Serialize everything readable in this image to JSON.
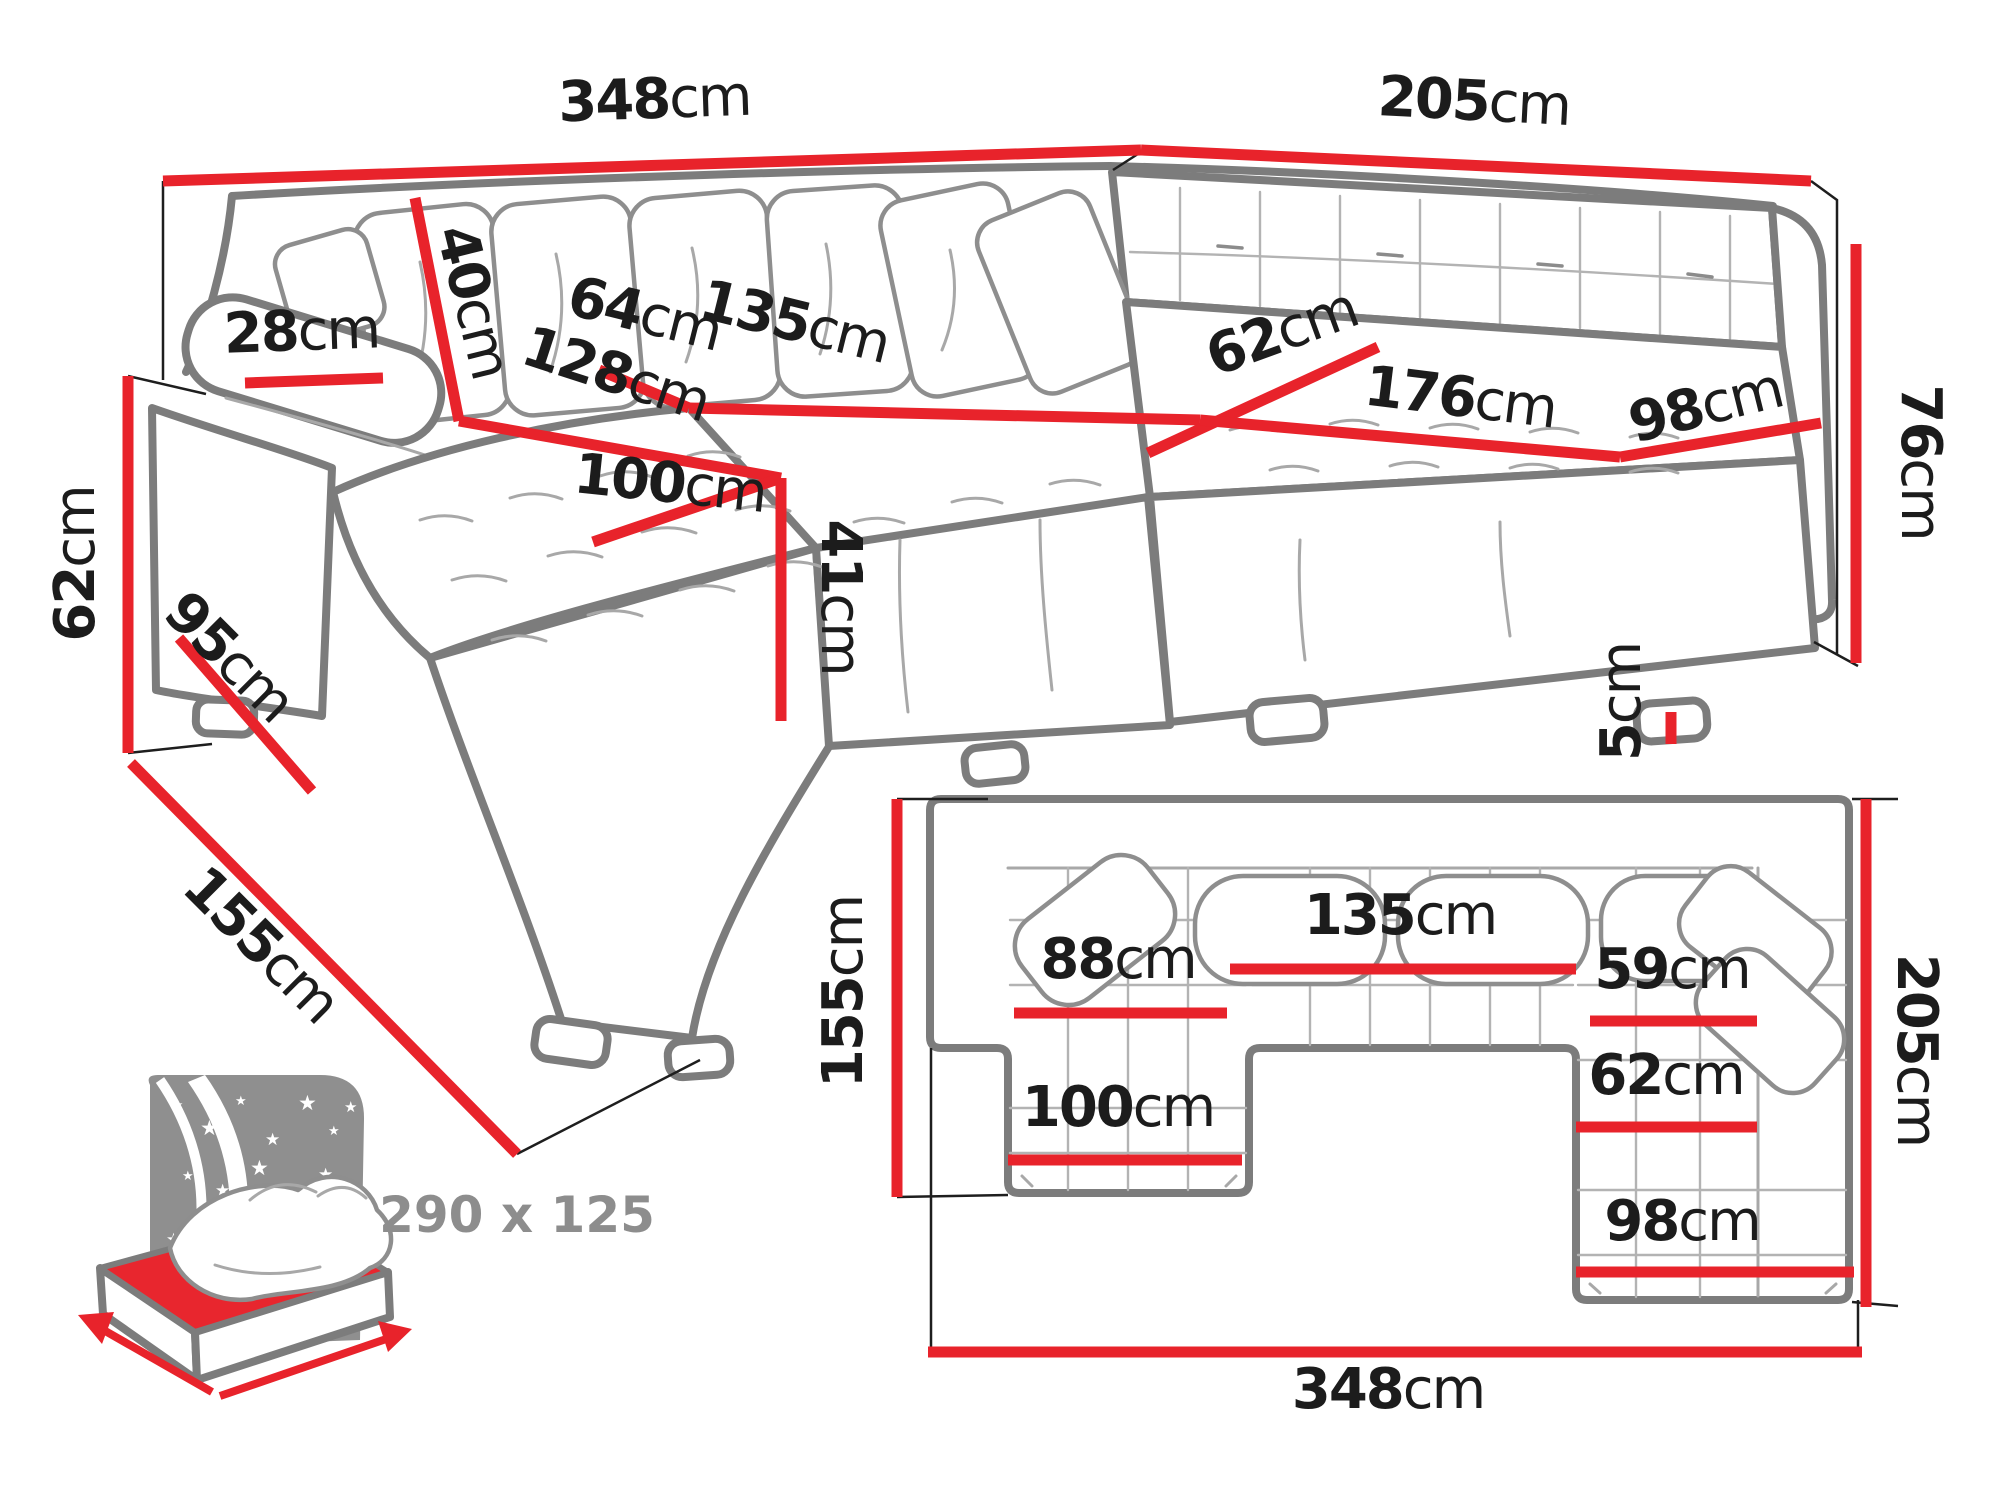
{
  "colors": {
    "dimension_red": "#e8232b",
    "sofa_outline_gray": "#7c7c7c",
    "label_black": "#1c1c1c",
    "bed_gray": "#8f8f8f",
    "bed_text_gray": "#8d8d8d"
  },
  "perspective_view": {
    "back_width": {
      "num": "348",
      "unit": "cm"
    },
    "right_width": {
      "num": "205",
      "unit": "cm"
    },
    "armrest_height": {
      "num": "62",
      "unit": "cm"
    },
    "armrest_top_depth": {
      "num": "28",
      "unit": "cm"
    },
    "armrest_base_length": {
      "num": "95",
      "unit": "cm"
    },
    "side_depth": {
      "num": "155",
      "unit": "cm"
    },
    "back_cushion_height": {
      "num": "40",
      "unit": "cm"
    },
    "seat_depth": {
      "num": "64",
      "unit": "cm"
    },
    "middle_seat_width": {
      "num": "135",
      "unit": "cm"
    },
    "chaise_length": {
      "num": "128",
      "unit": "cm"
    },
    "chaise_width": {
      "num": "100",
      "unit": "cm"
    },
    "seat_height": {
      "num": "41",
      "unit": "cm"
    },
    "corner_seat_width": {
      "num": "62",
      "unit": "cm"
    },
    "right_seat_length": {
      "num": "176",
      "unit": "cm"
    },
    "right_seat_depth": {
      "num": "98",
      "unit": "cm"
    },
    "total_height": {
      "num": "76",
      "unit": "cm"
    },
    "base_height": {
      "num": "5",
      "unit": "cm"
    }
  },
  "plan_view": {
    "left_depth": {
      "num": "155",
      "unit": "cm"
    },
    "chaise_seat_width": {
      "num": "88",
      "unit": "cm"
    },
    "middle_seat_width": {
      "num": "135",
      "unit": "cm"
    },
    "right_seat_width": {
      "num": "59",
      "unit": "cm"
    },
    "right_seat_depth": {
      "num": "62",
      "unit": "cm"
    },
    "right_chaise_width": {
      "num": "98",
      "unit": "cm"
    },
    "chaise_width": {
      "num": "100",
      "unit": "cm"
    },
    "right_depth": {
      "num": "205",
      "unit": "cm"
    },
    "total_width": {
      "num": "348",
      "unit": "cm"
    }
  },
  "bed_icon": {
    "sleeping_area": "290 x 125",
    "star_glyph": "★"
  }
}
